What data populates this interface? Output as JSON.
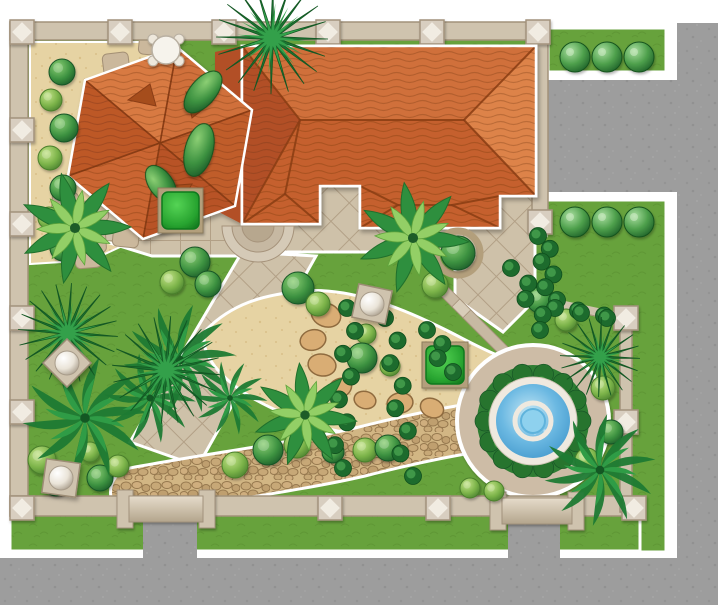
{
  "palette": {
    "bg": "#ffffff",
    "street": "#9d9d9d",
    "lawn": "#67a23c",
    "lawn_line": "#5a9031",
    "sand": "#e6d3a3",
    "sand_dot": "#d9c089",
    "tile": "#cec1a9",
    "tile_line": "#b2a086",
    "cobble": "#d2b684",
    "cobble_stone": "#c4a476",
    "cobble_joint": "#97794f",
    "wall": "#cfc3ae",
    "wall_edge": "#a2927a",
    "post": "#d8cec0",
    "post_hi": "#f4efe6",
    "post_edge": "#a2927c",
    "gate_light": "#e6dccb",
    "gate_dark": "#b3a58c",
    "roof_n": "#d0703a",
    "roof_e": "#dd8349",
    "roof_s": "#c5612d",
    "roof_w": "#b25028",
    "roof_hex": [
      "#d0703a",
      "#c05d2c",
      "#b85326",
      "#ca6530",
      "#bd5828",
      "#d87a42"
    ],
    "ridge": "#8a3d14",
    "vent": "#a54d1e",
    "roof_tex": "rgba(105,45,10,0.28)",
    "water": "#3d97cc",
    "water_light": "#bfe3f2",
    "pool_rim": "#efe9df",
    "shrub_ring": "#2e7d33",
    "shrub_blob": "#27742e",
    "plaza": "#cdbca6",
    "step_a": "#d8cdb9",
    "step_b": "#c7b9a2",
    "step_edge": "#a6937b",
    "stone": "#cbb89c",
    "stone_edge": "#a38f74",
    "boulder": "#d9ad74",
    "boulder_edge": "#8f6b3f",
    "bed_edge": "#ffffff",
    "sphere_edge": "#a89c8a",
    "planter": "#b39f7c",
    "hedge_edge": "#117a1f",
    "vine_dark": "#1d6b2d",
    "vine_light": "#3f9748",
    "palm_dark": "#1e7a33",
    "palm_light": "#2f9c46",
    "spiky_dark": "#1b7531",
    "spiky_light": "#33a04a",
    "fern_dark": "#2e8f3e",
    "fern_light": "#93cf66"
  },
  "scene": {
    "streets": [
      [
        677,
        23,
        41,
        582
      ],
      [
        548,
        80,
        170,
        112
      ],
      [
        0,
        558,
        718,
        47
      ]
    ],
    "lawns": [
      [
        548,
        28,
        118,
        44
      ],
      [
        546,
        200,
        120,
        352
      ],
      [
        10,
        515,
        630,
        36
      ]
    ],
    "gaps": [
      [
        143,
        516,
        54,
        89
      ],
      [
        508,
        518,
        52,
        87
      ]
    ],
    "interior": "28,40 540,40 540,230 628,318 628,515 28,515",
    "sand_top_left": "30,42 155,42 208,88 228,152 213,208 146,235 92,260 30,264",
    "sand_center": "M206,330 C232,304 262,295 302,291 C348,287 398,306 446,330 C478,346 500,360 540,368 C566,374 572,408 556,430 C538,452 508,448 478,436 C448,424 418,442 378,438 C338,434 292,420 256,400 C228,384 196,356 206,330 Z",
    "sand_small": [
      [
        512,
        468,
        48,
        48
      ]
    ],
    "patio_diag": [
      "242,186 535,186 535,300 503,332 455,298 455,252 242,252",
      "242,252 316,256 198,466 130,442"
    ],
    "patio_grid": [
      "100,190 242,190 242,256 152,256 100,240"
    ],
    "cobble": {
      "d": "M135,492 C210,478 300,466 360,452 C415,438 448,432 472,428",
      "width": 46,
      "pad": "118,468 214,468 214,500 118,500"
    },
    "stones": [
      [
        152,
        44,
        6
      ],
      [
        116,
        64,
        -7
      ],
      [
        149,
        92,
        5
      ],
      [
        109,
        114,
        -5
      ],
      [
        141,
        137,
        7
      ],
      [
        101,
        161,
        -6
      ],
      [
        134,
        186,
        5
      ],
      [
        95,
        211,
        -7
      ],
      [
        126,
        236,
        6
      ],
      [
        88,
        257,
        -5
      ],
      [
        65,
        203,
        4
      ],
      [
        93,
        242,
        -4
      ]
    ],
    "boulders": [
      [
        326,
        315,
        15,
        20
      ],
      [
        313,
        340,
        13,
        -15
      ],
      [
        322,
        365,
        14,
        10
      ],
      [
        340,
        388,
        12,
        -25
      ],
      [
        365,
        400,
        11,
        15
      ],
      [
        400,
        403,
        13,
        -10
      ],
      [
        432,
        408,
        12,
        25
      ]
    ],
    "walls": [
      [
        10,
        22,
        538,
        18
      ],
      [
        10,
        22,
        18,
        494
      ],
      [
        10,
        496,
        630,
        20
      ],
      [
        532,
        22,
        16,
        206
      ]
    ],
    "fence": {
      "diag": [
        548,
        302,
        624,
        318
      ],
      "vert": [
        620,
        314,
        12,
        198
      ]
    },
    "posts": [
      [
        22,
        32
      ],
      [
        120,
        32
      ],
      [
        224,
        32
      ],
      [
        328,
        32
      ],
      [
        432,
        32
      ],
      [
        538,
        32
      ],
      [
        22,
        130
      ],
      [
        22,
        224
      ],
      [
        22,
        318
      ],
      [
        22,
        412
      ],
      [
        22,
        508
      ],
      [
        330,
        508
      ],
      [
        438,
        508
      ],
      [
        634,
        508
      ],
      [
        540,
        222
      ],
      [
        626,
        318
      ],
      [
        626,
        422
      ]
    ],
    "gates": [
      [
        117,
        494,
        98,
        30
      ],
      [
        490,
        496,
        94,
        30
      ]
    ],
    "house": {
      "filler": "215,52 242,46 242,224 215,210",
      "hex": {
        "cx": 160,
        "cy": 143,
        "pts": [
          [
            177,
            47
          ],
          [
            252,
            110
          ],
          [
            235,
            206
          ],
          [
            143,
            239
          ],
          [
            68,
            176
          ],
          [
            85,
            80
          ]
        ],
        "vents": [
          "128,100 150,84 156,106",
          "186,92 212,102 192,118",
          "165,186 192,184 178,208"
        ]
      },
      "main": {
        "outline": "242,46 536,46 536,196 500,196 500,228 360,228 360,186 320,186 320,224 242,224",
        "facets": [
          [
            "242,46 536,46 464,120 300,120",
            "n"
          ],
          [
            "536,46 536,196 464,120",
            "e"
          ],
          [
            "242,46 300,120 242,224",
            "w"
          ],
          [
            "300,120 464,120 536,196 500,196 500,228 360,228 360,186 320,186 320,224 242,224",
            "s"
          ]
        ],
        "ridges": [
          [
            242,
            46,
            300,
            120
          ],
          [
            242,
            224,
            300,
            120
          ],
          [
            300,
            120,
            464,
            120
          ],
          [
            464,
            120,
            536,
            46
          ],
          [
            464,
            120,
            536,
            196
          ],
          [
            360,
            228,
            398,
            205
          ],
          [
            500,
            228,
            452,
            205
          ],
          [
            398,
            205,
            452,
            205
          ],
          [
            452,
            205,
            500,
            196
          ],
          [
            398,
            205,
            360,
            186
          ],
          [
            242,
            224,
            285,
            194
          ],
          [
            320,
            224,
            285,
            194
          ],
          [
            285,
            194,
            300,
            120
          ]
        ]
      },
      "porch_steps": {
        "cx": 258,
        "cy": 226,
        "radii": [
          36,
          26,
          16
        ]
      }
    },
    "fountain": {
      "cx": 533,
      "cy": 421,
      "plaza_r": 76,
      "shrub_r": 56,
      "rim_r": 44,
      "water_r": 37,
      "ring_r": 18,
      "inner_r": 12
    },
    "steps": [
      [
        459,
        306
      ],
      [
        470,
        317
      ],
      [
        482,
        329
      ],
      [
        493,
        340
      ]
    ],
    "plants": {
      "topiaries": [
        [
          575,
          57
        ],
        [
          607,
          57
        ],
        [
          639,
          57
        ],
        [
          575,
          222
        ],
        [
          607,
          222
        ],
        [
          639,
          222
        ]
      ],
      "bushes": [
        [
          62,
          72,
          13,
          "d"
        ],
        [
          51,
          100,
          11,
          "l"
        ],
        [
          64,
          128,
          14,
          "d"
        ],
        [
          50,
          158,
          12,
          "l"
        ],
        [
          63,
          188,
          13,
          "d"
        ],
        [
          49,
          218,
          11,
          "l"
        ],
        [
          63,
          248,
          13,
          "d"
        ],
        [
          195,
          262,
          15,
          "d"
        ],
        [
          172,
          282,
          12,
          "l"
        ],
        [
          208,
          284,
          13,
          "d"
        ],
        [
          298,
          288,
          16,
          "d"
        ],
        [
          318,
          304,
          12,
          "l"
        ],
        [
          435,
          285,
          13,
          "l"
        ],
        [
          366,
          334,
          10,
          "l"
        ],
        [
          362,
          358,
          15,
          "d"
        ],
        [
          390,
          366,
          10,
          "l"
        ],
        [
          268,
          450,
          15,
          "d"
        ],
        [
          297,
          445,
          13,
          "l"
        ],
        [
          333,
          452,
          11,
          "d"
        ],
        [
          365,
          450,
          12,
          "l"
        ],
        [
          388,
          448,
          13,
          "d"
        ],
        [
          235,
          465,
          13,
          "l"
        ],
        [
          42,
          460,
          14,
          "l"
        ],
        [
          56,
          484,
          12,
          "d"
        ],
        [
          100,
          478,
          13,
          "d"
        ],
        [
          90,
          452,
          10,
          "l"
        ],
        [
          118,
          466,
          11,
          "l"
        ],
        [
          603,
          388,
          12,
          "l"
        ],
        [
          611,
          432,
          12,
          "d"
        ],
        [
          587,
          460,
          12,
          "l"
        ],
        [
          470,
          488,
          10,
          "l"
        ],
        [
          494,
          491,
          10,
          "l"
        ],
        [
          540,
          300,
          13,
          "d"
        ],
        [
          566,
          320,
          11,
          "l"
        ]
      ],
      "ovals": [
        [
          203,
          92,
          13,
          25,
          40
        ],
        [
          199,
          150,
          14,
          27,
          15
        ],
        [
          161,
          184,
          12,
          21,
          -35
        ]
      ],
      "ferns": [
        [
          413,
          238,
          56
        ],
        [
          75,
          228,
          56
        ],
        [
          305,
          415,
          52
        ]
      ],
      "palms": [
        [
          180,
          360,
          54
        ],
        [
          85,
          418,
          60
        ],
        [
          150,
          398,
          44
        ],
        [
          600,
          470,
          54
        ],
        [
          230,
          398,
          36
        ]
      ],
      "spikies": [
        [
          272,
          38,
          56
        ],
        [
          68,
          333,
          50
        ],
        [
          166,
          370,
          54
        ],
        [
          600,
          357,
          40
        ]
      ],
      "vines": [
        [
          543,
          236,
          552,
          300,
          6
        ],
        [
          560,
          308,
          612,
          318,
          5
        ],
        [
          352,
          308,
          338,
          468,
          8
        ],
        [
          390,
          318,
          408,
          476,
          8
        ],
        [
          516,
          268,
          545,
          330,
          5
        ],
        [
          432,
          330,
          448,
          372,
          4
        ]
      ],
      "hedges": [
        [
          162,
          192,
          37
        ],
        [
          426,
          346,
          38
        ]
      ],
      "planter_bush": [
        458,
        253
      ]
    },
    "ornaments": {
      "ball_posts": [
        [
          372,
          304,
          12
        ],
        [
          67,
          363,
          45
        ],
        [
          61,
          478,
          8
        ]
      ],
      "table": [
        166,
        50
      ]
    }
  }
}
